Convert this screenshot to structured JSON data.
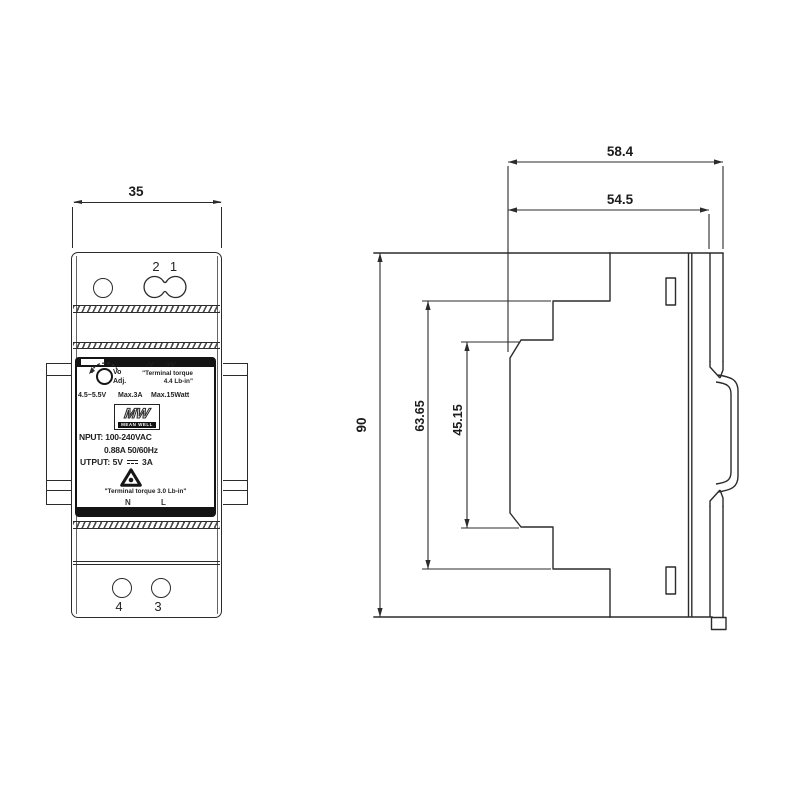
{
  "colors": {
    "line": "#2b2b2b",
    "text": "#1c1c1c",
    "label_black": "#141414"
  },
  "front_view": {
    "dim_width": "35",
    "terminal_labels_top": [
      "2",
      "1"
    ],
    "terminal_labels_bottom": [
      "4",
      "3"
    ],
    "label": {
      "vo": "Vo",
      "adj": "Adj.",
      "neg": "-V",
      "pos": "+V",
      "torque_top_line1": "\"Terminal torque",
      "torque_top_line2": "4.4 Lb-in\"",
      "range": "4.5~5.5V",
      "max_a": "Max.3A",
      "max_w": "Max.15Watt",
      "logo": "MW",
      "brand": "MEAN WELL",
      "input": "NPUT: 100-240VAC",
      "input2": "0.88A  50/60Hz",
      "output_prefix": "UTPUT:  5V",
      "output_suffix": "3A",
      "torque_bottom": "\"Terminal torque 3.0 Lb-in\"",
      "n": "N",
      "l": "L"
    }
  },
  "side_view": {
    "dim_total_depth": "58.4",
    "dim_case_depth": "54.5",
    "dim_height": "90",
    "dim_body_height": "63.65",
    "dim_recess_height": "45.15"
  }
}
